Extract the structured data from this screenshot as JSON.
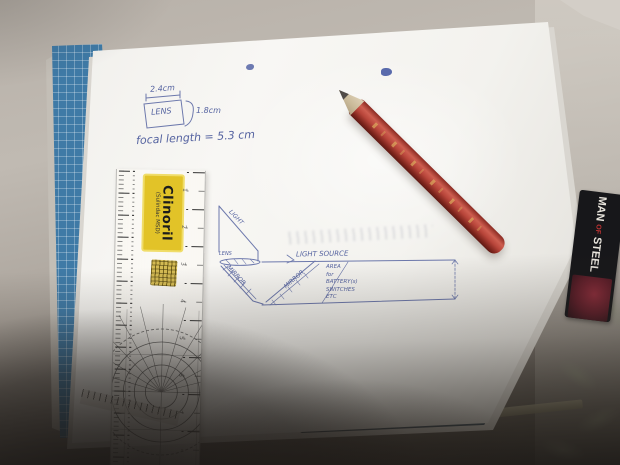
{
  "labels": {
    "lens_sketch": {
      "width": "2.4cm",
      "lens": "LENS",
      "height": "1.8cm",
      "focal": "focal length = 5.3 cm"
    },
    "diagram": {
      "light": "LIGHT",
      "lens": "LENS",
      "mirror_left": "MIRROR",
      "mirror_right": "MIRROR",
      "light_source": "LIGHT SOURCE",
      "area_box": [
        "AREA",
        "for",
        "BATTERY(s)",
        "SWITCHES",
        "ETC"
      ]
    }
  },
  "ruler": {
    "brand": "Clinoril",
    "brand_sub": "(Sulindac MSD)",
    "numbers": [
      "1",
      "2",
      "3",
      "4",
      "5",
      "6",
      "7"
    ]
  },
  "card": {
    "line1": "MAN",
    "line2": "OF",
    "line3": "STEEL"
  },
  "colors": {
    "ink_blue": "#5563a0",
    "pencil_red": "#b8453a",
    "label_yellow": "#e2c328",
    "book_blue": "#3f7aa6",
    "card_black": "#17171a",
    "paper_white": "#f3f2ee"
  }
}
